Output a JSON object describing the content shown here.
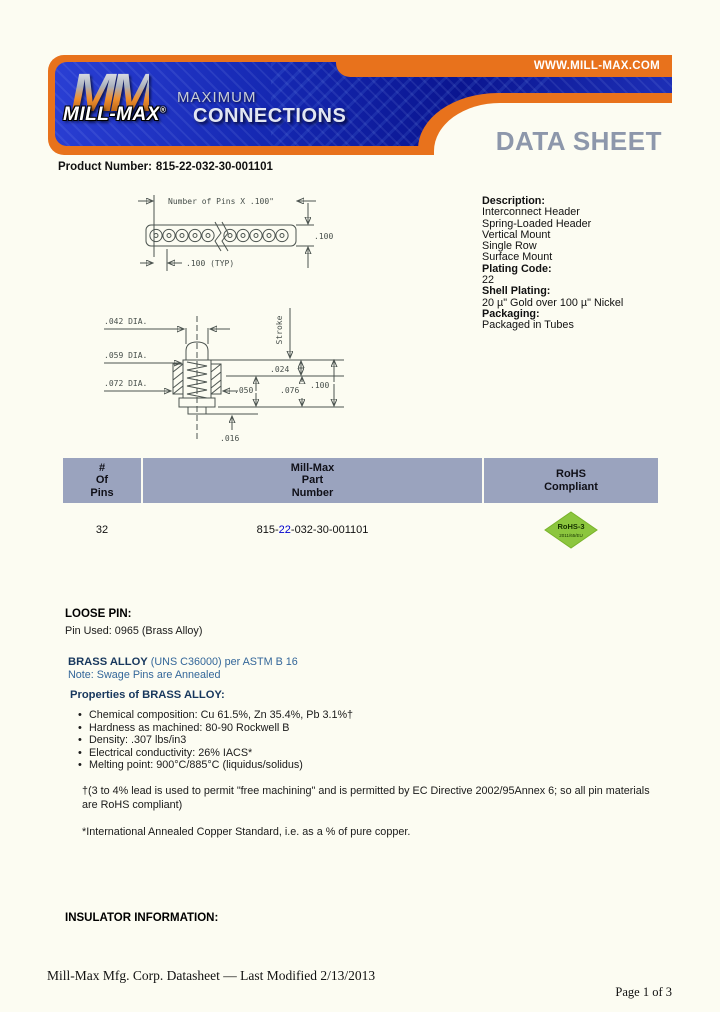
{
  "header": {
    "url_label": "WWW.MILL-MAX.COM",
    "logo_mm": "MM",
    "logo_name": "MILL-MAX",
    "logo_reg": "®",
    "tagline_top": "MAXIMUM",
    "tagline_bottom": "CONNECTIONS",
    "sheet_title": "DATA SHEET"
  },
  "product": {
    "label": "Product Number:",
    "number": "815-22-032-30-001101"
  },
  "drawing": {
    "row_view": {
      "top_dim": "Number of Pins X .100\"",
      "right_dim": ".100",
      "pitch_dim": ".100 (TYP)"
    },
    "section_view": {
      "dia_042": ".042 DIA.",
      "dia_059": ".059 DIA.",
      "dia_072": ".072 DIA.",
      "stroke": "Stroke",
      "dim_024": ".024",
      "dim_050": ".050",
      "dim_076": ".076",
      "dim_100": ".100",
      "dim_016": ".016"
    }
  },
  "description": {
    "heading": "Description:",
    "lines": [
      "Interconnect Header",
      "Spring-Loaded Header",
      "Vertical Mount",
      "Single Row",
      "Surface Mount"
    ],
    "plating_code_label": "Plating Code:",
    "plating_code_value": "22",
    "shell_plating_label": "Shell Plating:",
    "shell_plating_value": "20 µ\" Gold over 100 µ\" Nickel",
    "packaging_label": "Packaging:",
    "packaging_value": "Packaged in Tubes"
  },
  "table": {
    "col_pins": [
      "#",
      "Of",
      "Pins"
    ],
    "col_part": [
      "Mill-Max",
      "Part",
      "Number"
    ],
    "col_rohs": [
      "RoHS",
      "Compliant"
    ],
    "row": {
      "pins": "32",
      "part_prefix": "815-",
      "part_link": "22",
      "part_suffix": "-032-30-001101",
      "rohs_line1": "RoHS-3",
      "rohs_line2": "2011/65/EU"
    }
  },
  "loose_pin": {
    "heading": "LOOSE PIN:",
    "pin_used": "Pin Used: 0965 (Brass Alloy)"
  },
  "brass_alloy": {
    "title": "BRASS ALLOY",
    "title_detail": "(UNS C36000) per ASTM B 16",
    "note": "Note: Swage Pins are Annealed",
    "properties_heading": "Properties of BRASS ALLOY:",
    "bullets": [
      "Chemical composition: Cu 61.5%, Zn 35.4%, Pb 3.1%†",
      "Hardness as machined: 80-90 Rockwell B",
      "Density: .307 lbs/in3",
      "Electrical conductivity: 26% IACS*",
      "Melting point: 900°C/885°C (liquidus/solidus)"
    ],
    "footnote_lead": "†(3 to 4% lead is used to permit \"free machining\" and is permitted by EC Directive 2002/95Annex 6; so all pin materials are RoHS compliant)",
    "footnote_iacs": "*International Annealed Copper Standard, i.e. as a % of pure copper."
  },
  "insulator": {
    "heading": "INSULATOR INFORMATION:"
  },
  "footer": {
    "left": "Mill-Max Mfg. Corp. Datasheet — Last Modified 2/13/2013",
    "right": "Page 1 of 3"
  },
  "colors": {
    "orange": "#E8721C",
    "banner_blue": "#1525A8",
    "sheet_title_gray": "#8D97AB",
    "table_header": "#9AA3BE",
    "navy_heading": "#17375D",
    "blue_text": "#336699",
    "link_blue": "#0000CD",
    "rohs_green": "#8CC63E"
  }
}
